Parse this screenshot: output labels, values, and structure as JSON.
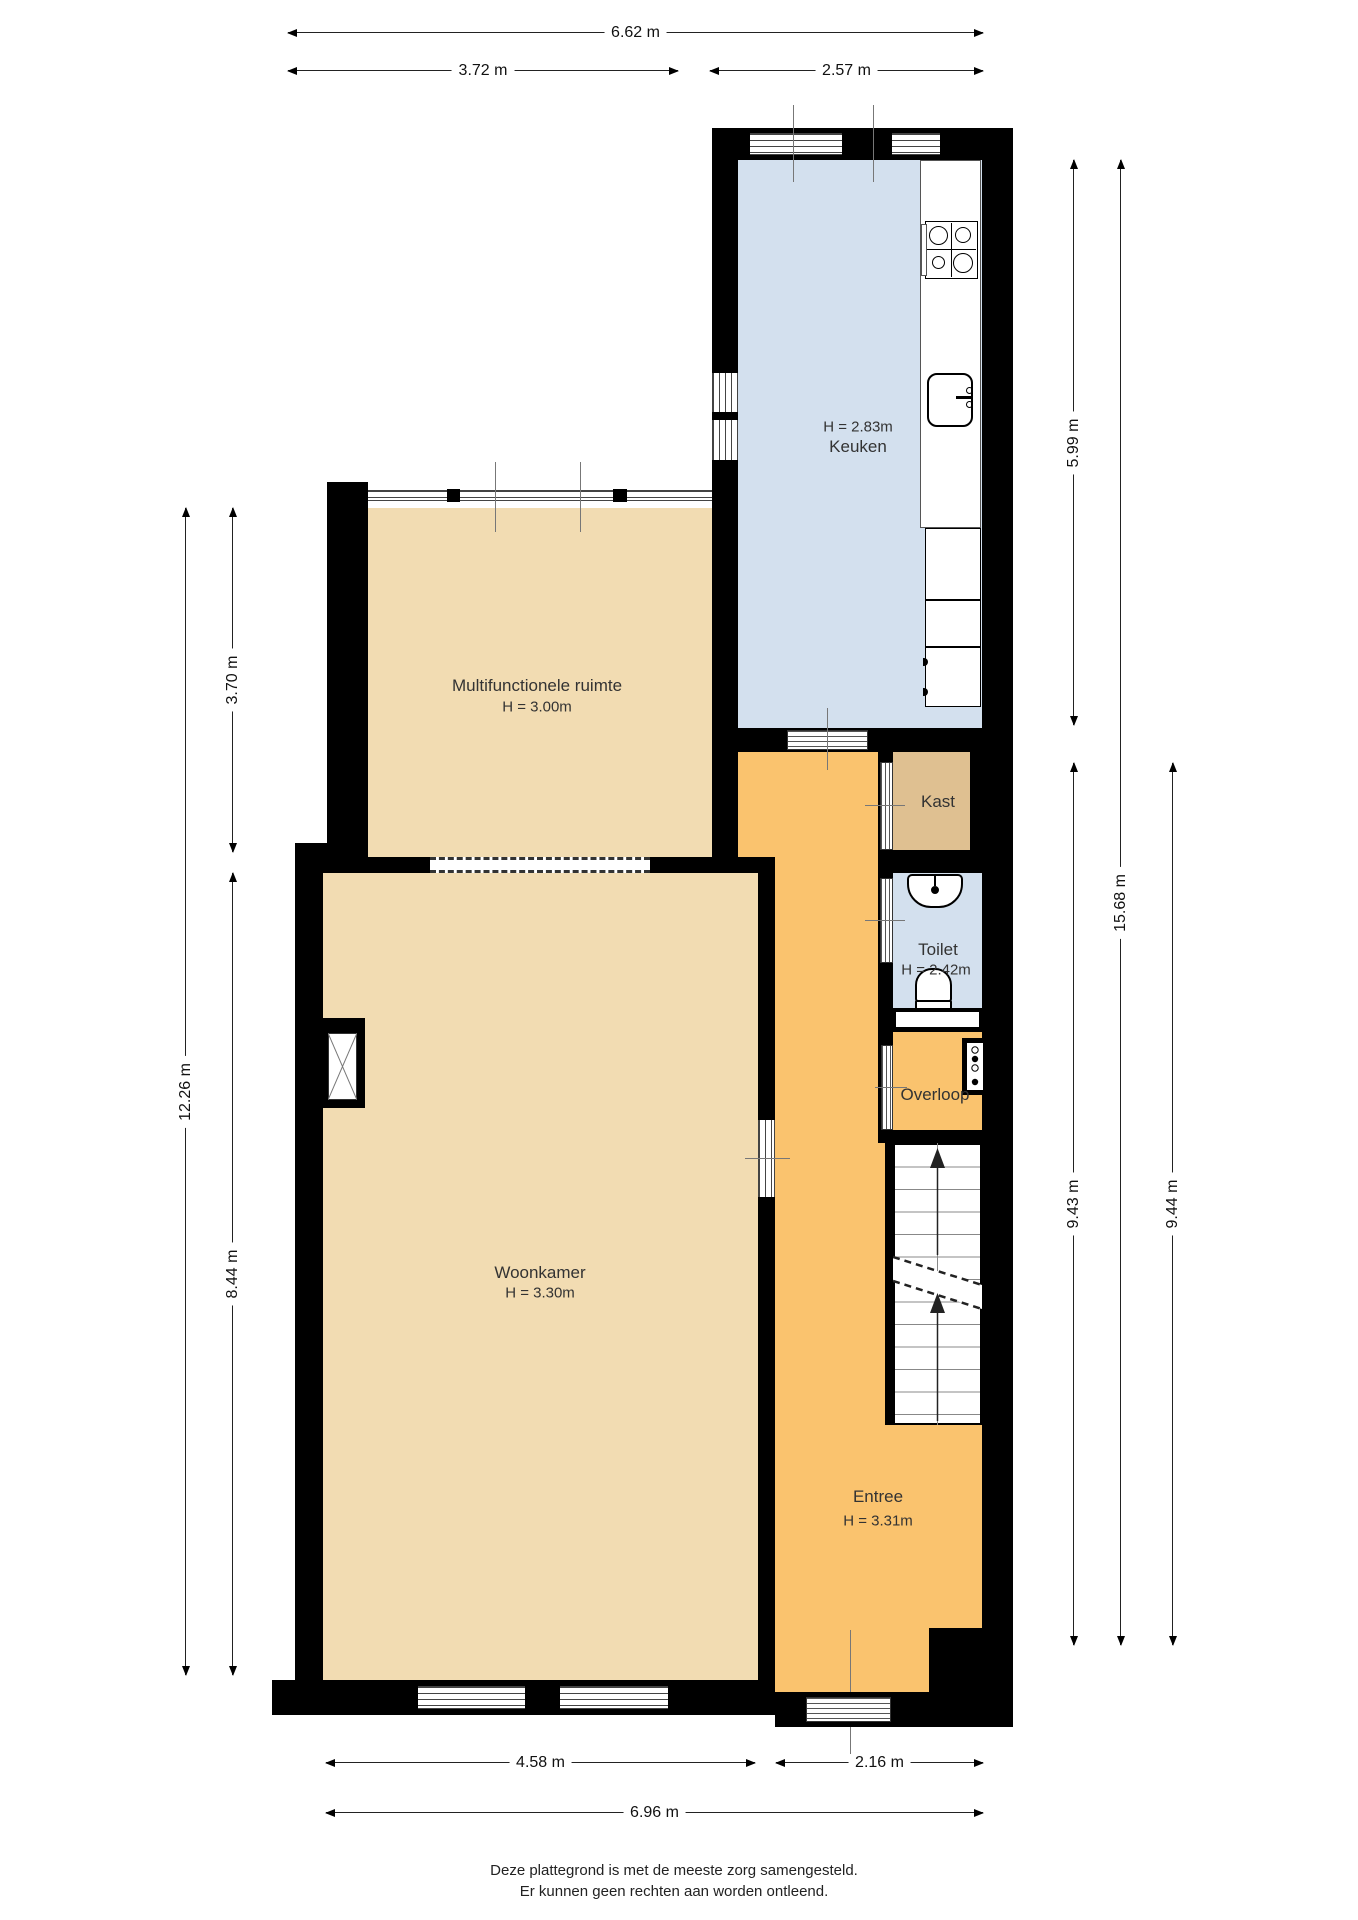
{
  "rooms": {
    "keuken": {
      "name": "Keuken",
      "height": "H = 2.83m"
    },
    "multifunctionele": {
      "name": "Multifunctionele ruimte",
      "height": "H = 3.00m"
    },
    "woonkamer": {
      "name": "Woonkamer",
      "height": "H = 3.30m"
    },
    "entree": {
      "name": "Entree",
      "height": "H = 3.31m"
    },
    "kast": {
      "name": "Kast"
    },
    "toilet": {
      "name": "Toilet",
      "height": "H = 2.42m"
    },
    "overloop": {
      "name": "Overloop"
    }
  },
  "dimensions": {
    "top_total": "6.62 m",
    "top_left": "3.72 m",
    "top_right": "2.57 m",
    "left_upper": "3.70 m",
    "left_total": "12.26 m",
    "left_lower": "8.44 m",
    "right_kitchen": "5.99 m",
    "right_total": "15.68 m",
    "right_inner": "9.43 m",
    "right_outer": "9.44 m",
    "bottom_left": "4.58 m",
    "bottom_right": "2.16 m",
    "bottom_total": "6.96 m"
  },
  "footer": {
    "line1": "Deze plattegrond is met de meeste zorg samengesteld.",
    "line2": "Er kunnen geen rechten aan worden ontleend."
  },
  "colors": {
    "wall": "#000000",
    "floor_tan": "#f2dcb2",
    "floor_orange": "#fac36e",
    "floor_blue": "#d3e0ee",
    "floor_kast": "#dfc091"
  }
}
